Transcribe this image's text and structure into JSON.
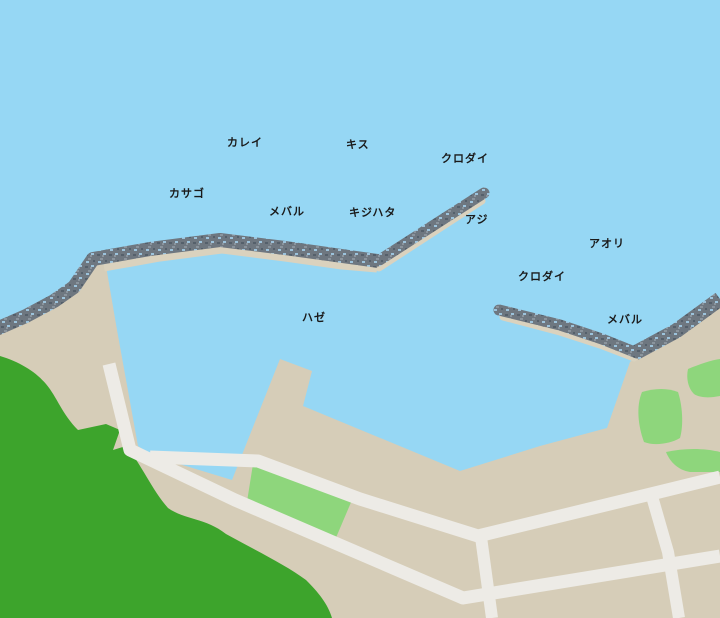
{
  "map": {
    "name": "harbor-fishing-point-map",
    "labels": [
      {
        "id": "spot-karei",
        "text": "カレイ"
      },
      {
        "id": "spot-kisu",
        "text": "キス"
      },
      {
        "id": "spot-kurodai-1",
        "text": "クロダイ"
      },
      {
        "id": "spot-kasago",
        "text": "カサゴ"
      },
      {
        "id": "spot-mebaru-1",
        "text": "メバル"
      },
      {
        "id": "spot-kijihata",
        "text": "キジハタ"
      },
      {
        "id": "spot-aji",
        "text": "アジ"
      },
      {
        "id": "spot-aori",
        "text": "アオリ"
      },
      {
        "id": "spot-kurodai-2",
        "text": "クロダイ"
      },
      {
        "id": "spot-mebaru-2",
        "text": "メバル"
      },
      {
        "id": "spot-haze",
        "text": "ハゼ"
      }
    ],
    "colors": {
      "sea": "#96D7F4",
      "land": "#D6CDB8",
      "walkway": "#DAD2BE",
      "rock_base": "#6E7780",
      "rock_dark": "#55606B",
      "rock_speckle": "#9CC3DC",
      "rock_light": "#8A949D",
      "forest": "#3DA42C",
      "park": "#8ED67C",
      "road": "#EDEBE6",
      "label_text": "#1A1A1A"
    }
  }
}
